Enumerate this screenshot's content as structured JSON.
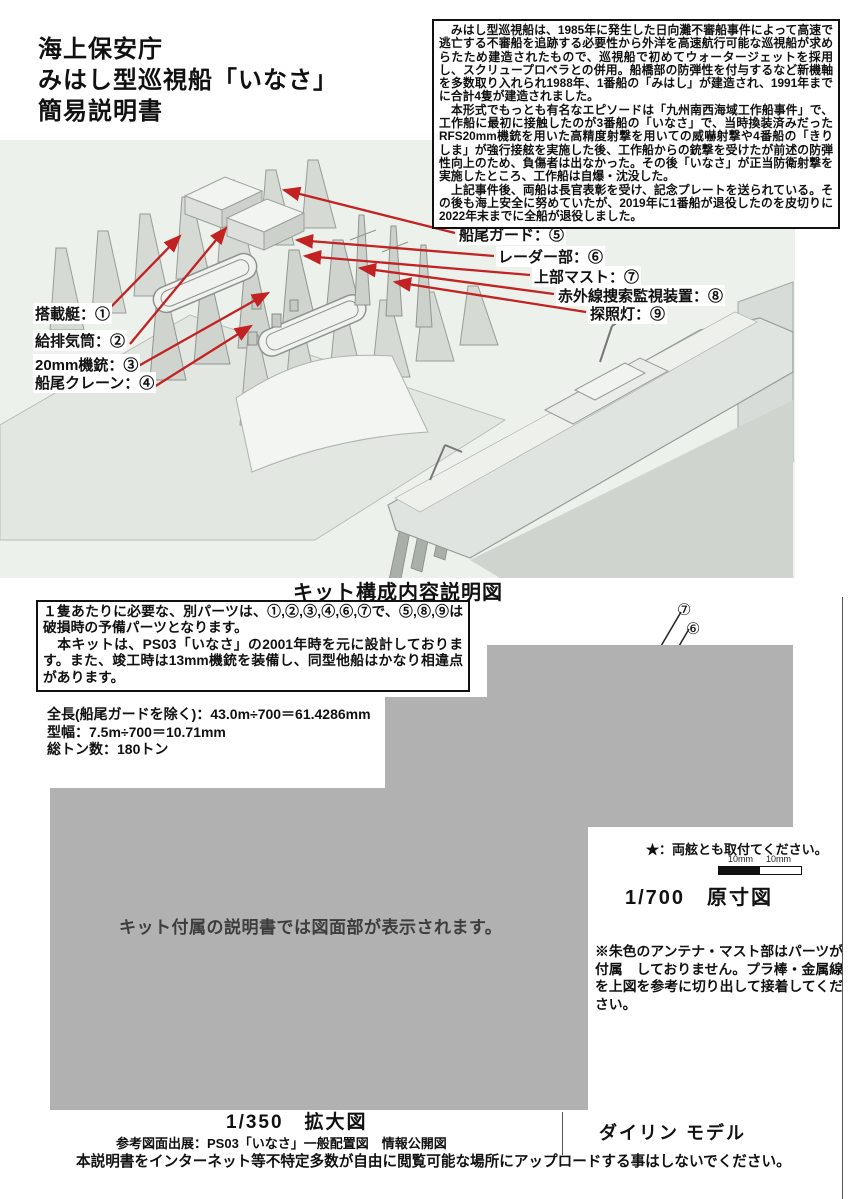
{
  "header": {
    "title_lines": "海上保安庁\nみはし型巡視船「いなさ」\n簡易説明書"
  },
  "info_box": {
    "paragraph1": "　みはし型巡視船は、1985年に発生した日向灘不審船事件によって高速で逃亡する不審船を追跡する必要性から外洋を高速航行可能な巡視船が求めらたため建造されたもので、巡視船で初めてウォータージェットを採用し、スクリュープロペラとの併用。船橋部の防弾性を付与するなど新機軸を多数取り入れられ1988年、1番船の「みはし」が建造され、1991年までに合計4隻が建造されました。",
    "paragraph2": "　本形式でもっとも有名なエピソードは「九州南西海域工作船事件」で、工作船に最初に接触したのが3番船の「いなさ」で、当時換装済みだったRFS20mm機銃を用いた高精度射撃を用いての威嚇射撃や4番船の「きりしま」が強行接舷を実施した後、工作船からの銃撃を受けたが前述の防弾性向上のため、負傷者は出なかった。その後「いなさ」が正当防衛射撃を実施したところ、工作船は自爆・沈没した。",
    "paragraph3": "　上記事件後、両船は長官表彰を受け、記念プレートを送られている。その後も海上安全に努めていたが、2019年に1番船が退役したのを皮切りに2022年末までに全船が退役しました。"
  },
  "diagram": {
    "caption": "キット構成内容説明図",
    "labels_left": [
      "搭載艇：①",
      "給排気筒：②",
      "20mm機銃：③",
      "船尾クレーン：④"
    ],
    "labels_right": [
      "船尾ガード：⑤",
      "レーダー部：⑥",
      "上部マスト：⑦",
      "赤外線捜索監視装置：⑧",
      "探照灯：⑨"
    ]
  },
  "parts_note": {
    "paragraph1": "１隻あたりに必要な、別パーツは、①,②,③,④,⑥,⑦で、⑤,⑧,⑨は破損時の予備パーツとなります。",
    "paragraph2": "　本キットは、PS03「いなさ」の2001年時を元に設計しております。また、竣工時は13mm機銃を装備し、同型他船はかなり相違点があります。"
  },
  "specs": {
    "lines": "全長(船尾ガードを除く)：43.0m÷700＝61.4286mm\n型幅：7.5m÷700＝10.71mm\n総トン数：180トン"
  },
  "placeholder": {
    "text": "キット付属の説明書では図面部が表示されます。"
  },
  "callouts": {
    "upper": "⑦",
    "lower": "⑥"
  },
  "scale_section": {
    "star_note": "★：両舷とも取付てください。",
    "scale_label_left": "10mm",
    "scale_label_right": "10mm",
    "scale_title": "1/700　原寸図",
    "antenna_note": "※朱色のアンテナ・マスト部はパーツが付属　しておりません。プラ棒・金属線を上図を参考に切り出して接着してください。"
  },
  "footer": {
    "enlarged_title": "1/350　拡大図",
    "brand": "ダイリン モデル",
    "source": "参考図面出展：PS03「いなさ」一般配置図　情報公開図",
    "warning": "本説明書をインターネット等不特定多数が自由に閲覧可能な場所にアップロードする事はしないでください。"
  },
  "colors": {
    "leader_red": "#c22222",
    "gray_block": "#b1b1b1",
    "illustration_bg": "#edf1ec"
  }
}
